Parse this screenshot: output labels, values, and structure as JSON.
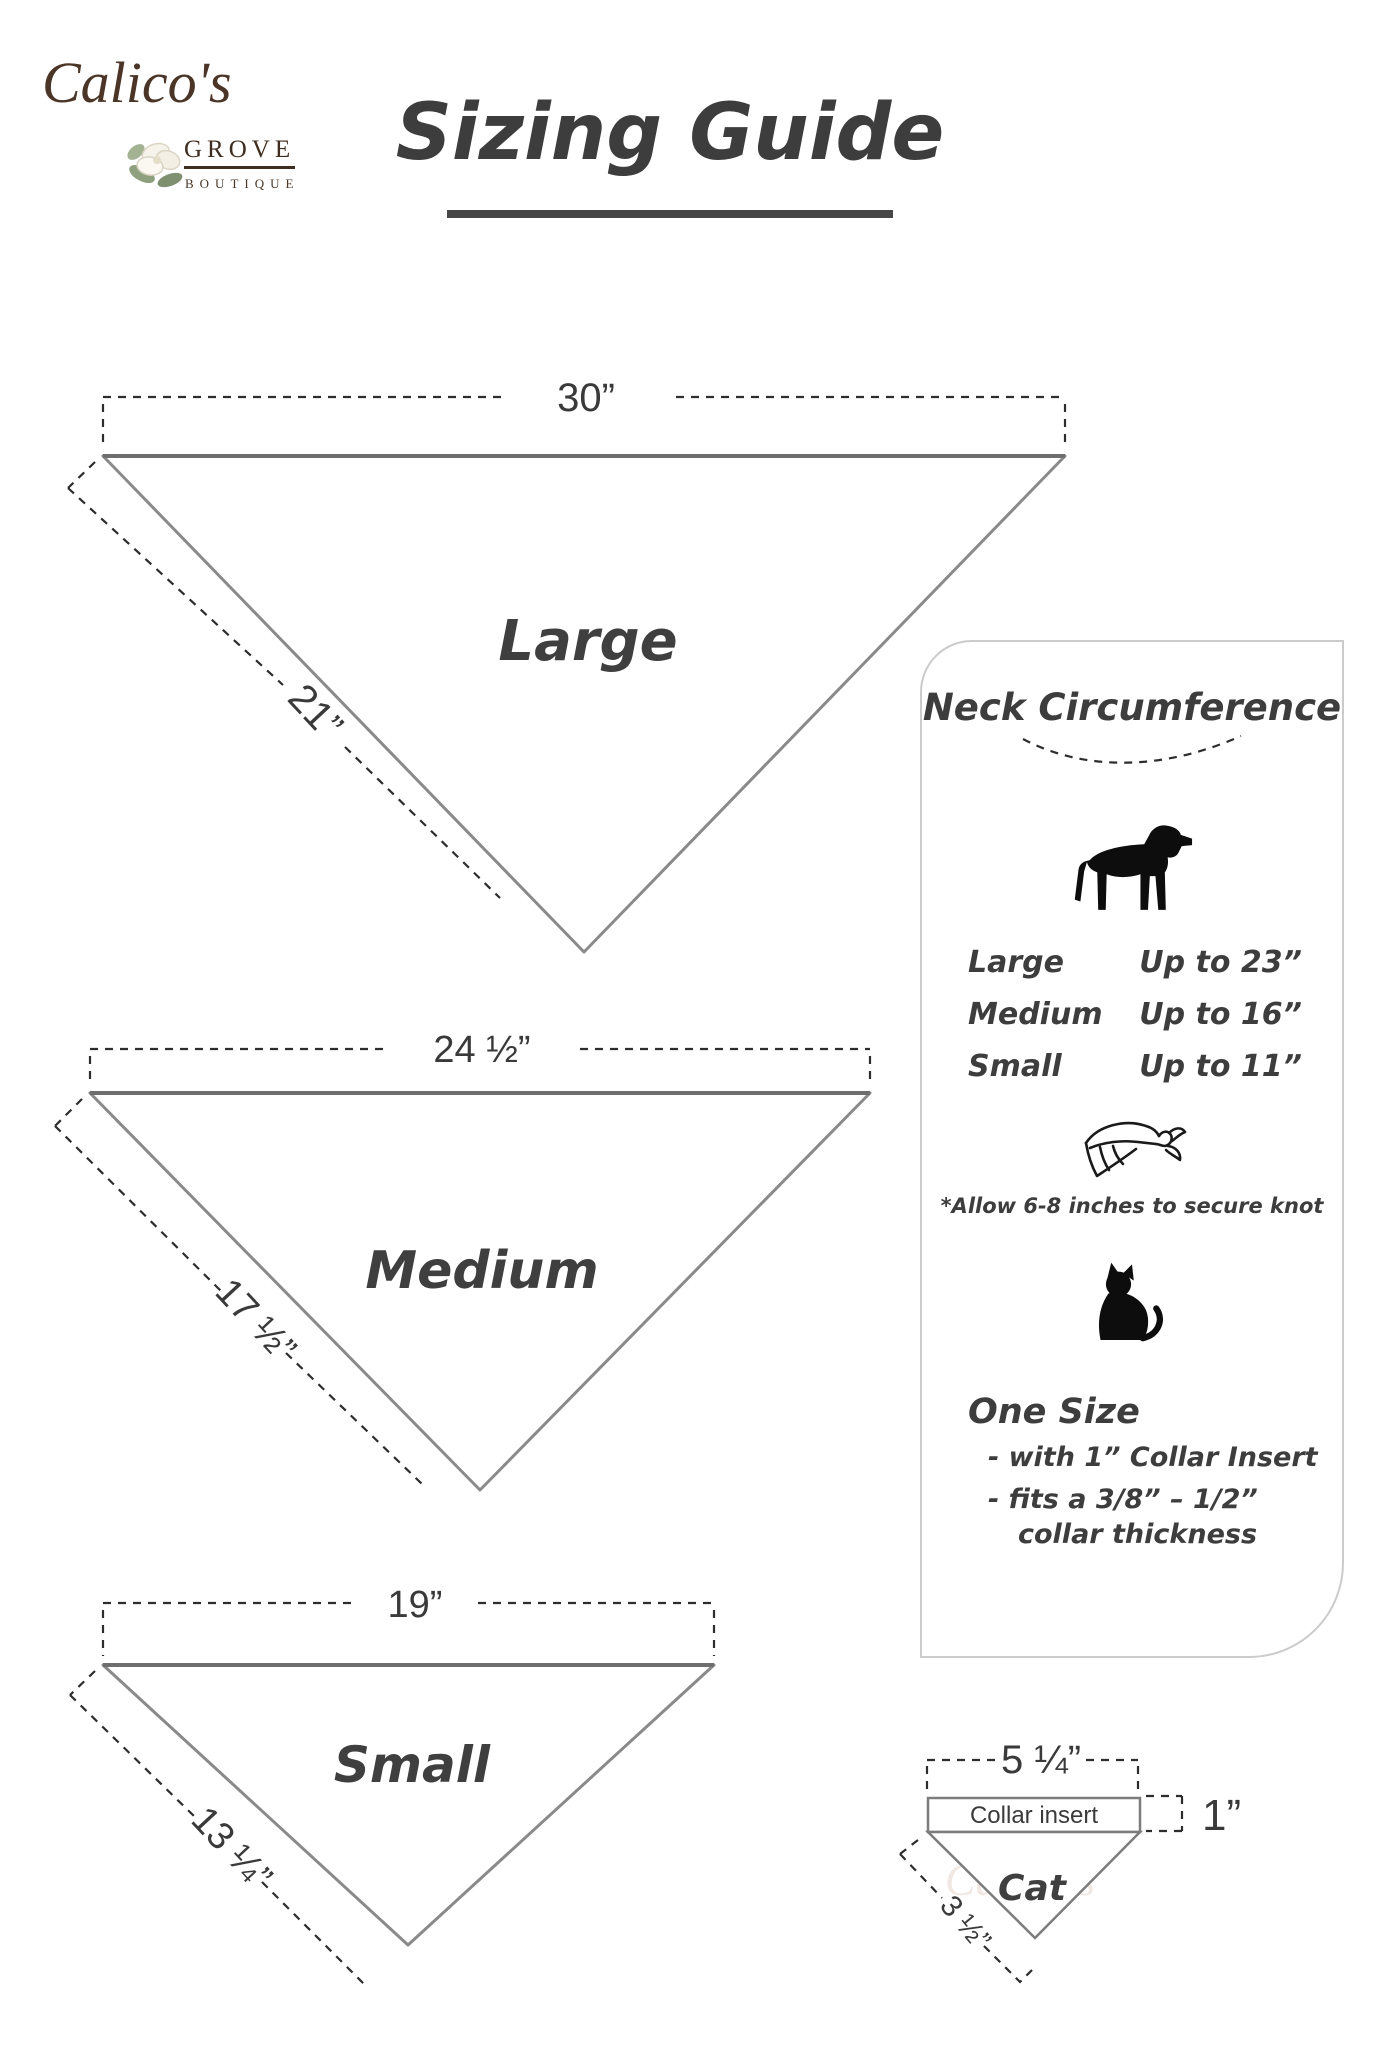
{
  "logo": {
    "name": "Calico's",
    "grove": "GROVE",
    "boutique": "BOUTIQUE",
    "flower_icon": "magnolia-flower-icon"
  },
  "title": {
    "text": "Sizing Guide"
  },
  "bandanas": [
    {
      "label": "Large",
      "top_width": "30”",
      "side_length": "21”"
    },
    {
      "label": "Medium",
      "top_width": "24 ½”",
      "side_length": "17 ½”"
    },
    {
      "label": "Small",
      "top_width": "19”",
      "side_length": "13 ¼”"
    }
  ],
  "neck_panel": {
    "title": "Neck Circumference",
    "sizes": [
      {
        "label": "Large",
        "value": "Up to 23”"
      },
      {
        "label": "Medium",
        "value": "Up to 16”"
      },
      {
        "label": "Small",
        "value": "Up to 11”"
      }
    ],
    "knot_note": "*Allow 6-8 inches to secure knot",
    "one_size_heading": "One Size",
    "one_size_line1": "- with 1” Collar Insert",
    "one_size_line2": "- fits a 3/8” – 1/2”",
    "one_size_line3": "collar thickness"
  },
  "cat_diagram": {
    "top_width": "5 ¼”",
    "collar_label": "Collar insert",
    "collar_height": "1”",
    "label": "Cat",
    "side_length": "3 ½”"
  },
  "icons": {
    "dog": "dog-silhouette",
    "bandana": "bandana-knot",
    "cat": "cat-silhouette"
  },
  "colors": {
    "logo_brown": "#4b3526",
    "text_dark": "#3d3d3d",
    "outline_gray": "#8a8a8a",
    "dash_dark": "#2d2d2d",
    "panel_border": "#cbcbcb",
    "watermark": "#f1e8e4"
  }
}
